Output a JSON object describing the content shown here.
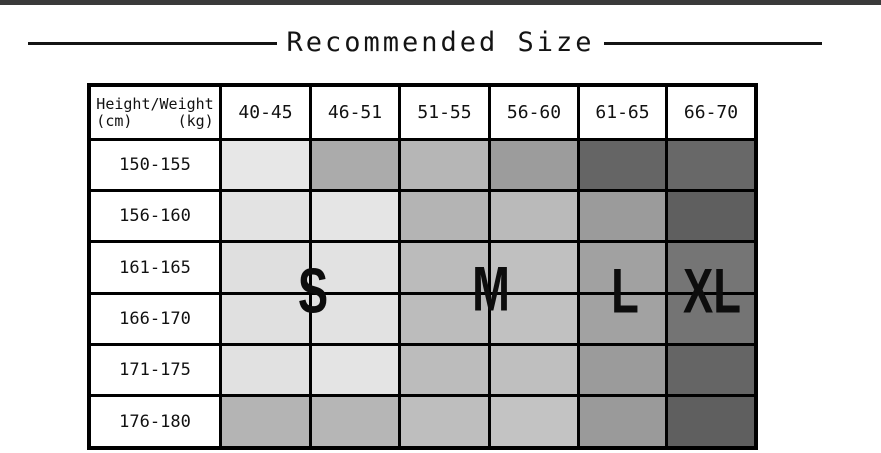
{
  "page": {
    "background": "#ffffff",
    "top_bar_color": "#3a3a3a"
  },
  "title": {
    "text": "Recommended Size"
  },
  "table": {
    "corner": {
      "line1": "Height/Weight",
      "line2": "(cm)     (kg)"
    },
    "weight_headers": [
      "40-45",
      "46-51",
      "51-55",
      "56-60",
      "61-65",
      "66-70"
    ],
    "rows": [
      {
        "label": "150-155",
        "cells": [
          "#e7e7e7",
          "#ababab",
          "#b6b6b6",
          "#9c9c9c",
          "#656565",
          "#686868"
        ]
      },
      {
        "label": "156-160",
        "cells": [
          "#e3e3e3",
          "#e5e5e5",
          "#b4b4b4",
          "#bababa",
          "#9b9b9b",
          "#5f5f5f"
        ]
      },
      {
        "label": "161-165",
        "cells": [
          "#dfdfdf",
          "#e2e2e2",
          "#bbbbbb",
          "#c0c0c0",
          "#a1a1a1",
          "#757575"
        ]
      },
      {
        "label": "166-170",
        "cells": [
          "#e0e0e0",
          "#e2e2e2",
          "#bcbcbc",
          "#c1c1c1",
          "#a2a2a2",
          "#747474"
        ]
      },
      {
        "label": "171-175",
        "cells": [
          "#e1e1e1",
          "#e4e4e4",
          "#bcbcbc",
          "#bfbfbf",
          "#9b9b9b",
          "#656565"
        ]
      },
      {
        "label": "176-180",
        "cells": [
          "#b4b4b4",
          "#b6b6b6",
          "#bebebe",
          "#c3c3c3",
          "#9a9a9a",
          "#5f5f5f"
        ]
      }
    ],
    "size_labels": {
      "s": "S",
      "m": "M",
      "l": "L",
      "xl": "XL"
    }
  },
  "chart_data": {
    "type": "table",
    "title": "Recommended Size",
    "row_axis_label": "Height (cm)",
    "column_axis_label": "Weight (kg)",
    "columns": [
      "40-45",
      "46-51",
      "51-55",
      "56-60",
      "61-65",
      "66-70"
    ],
    "rows": [
      "150-155",
      "156-160",
      "161-165",
      "166-170",
      "171-175",
      "176-180"
    ],
    "size_regions": [
      {
        "size": "S",
        "weight_columns": [
          "40-45",
          "46-51"
        ]
      },
      {
        "size": "M",
        "weight_columns": [
          "51-55",
          "56-60"
        ]
      },
      {
        "size": "L",
        "weight_columns": [
          "61-65"
        ]
      },
      {
        "size": "XL",
        "weight_columns": [
          "66-70"
        ]
      }
    ],
    "legend_position": "overlaid on grid, vertically centered",
    "grid": true
  }
}
